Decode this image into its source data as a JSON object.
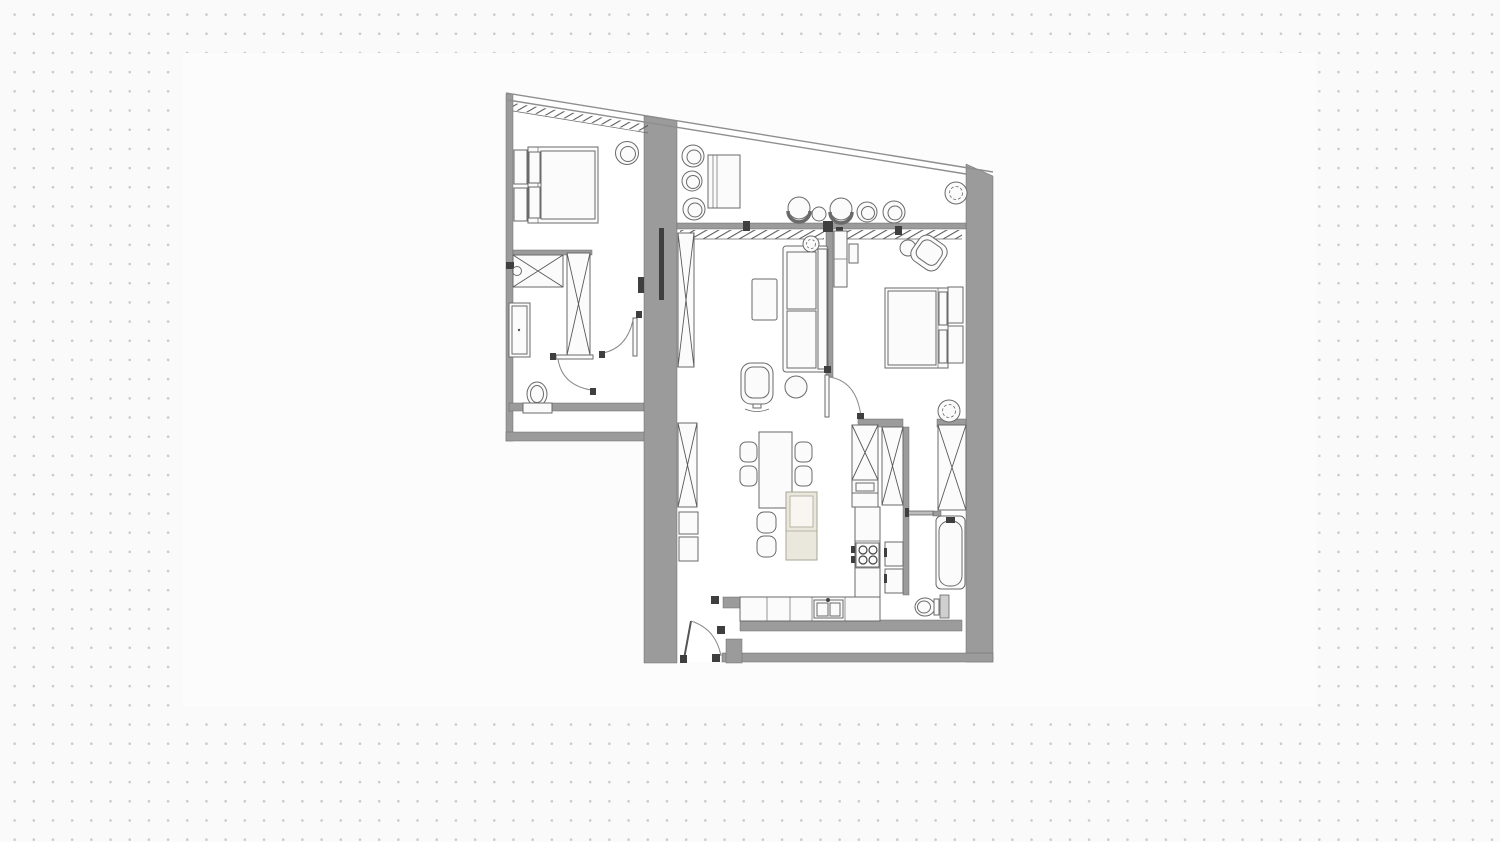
{
  "canvas": {
    "width": 1500,
    "height": 842
  },
  "palette": {
    "background": "#fafafa",
    "dot": "#c9c9c9",
    "panel": "#fcfcfc",
    "wall": "#9b9b9b",
    "wall_dark": "#3f3f3f",
    "outline": "#6a6a6a",
    "furniture_fill": "#fbfbfb",
    "floor": "#ffffff",
    "island_fill": "#eae8dc"
  },
  "floorplan": {
    "type": "apartment-floor-plan",
    "text_labels": [],
    "symbols": [
      "double-bed",
      "double-bed",
      "nightstand",
      "nightstand",
      "nightstand",
      "nightstand",
      "wardrobe-x",
      "wardrobe-x",
      "wardrobe-x",
      "wardrobe-x",
      "wardrobe-x",
      "tall-cabinet-x",
      "sofa",
      "coffee-table",
      "swivel-armchair",
      "pouf",
      "plant",
      "plant",
      "plant",
      "dining-table",
      "dining-chair",
      "dining-chair",
      "dining-chair",
      "dining-chair",
      "island-chair",
      "island-chair",
      "kitchen-island",
      "kitchen-counter",
      "sink",
      "cooktop",
      "oven-stack",
      "drawer-cabinet",
      "bathtub",
      "toilet",
      "toilet",
      "shower-tray",
      "storage-column",
      "balcony-chair",
      "balcony-chair",
      "balcony-chair",
      "balcony-table",
      "lounge-chair",
      "lounge-chair",
      "side-table",
      "side-table",
      "round-chair",
      "door-swing",
      "door-swing",
      "door-swing",
      "door-swing",
      "entrance-door",
      "sliding-door",
      "window-wall",
      "curtain-hatch"
    ]
  }
}
